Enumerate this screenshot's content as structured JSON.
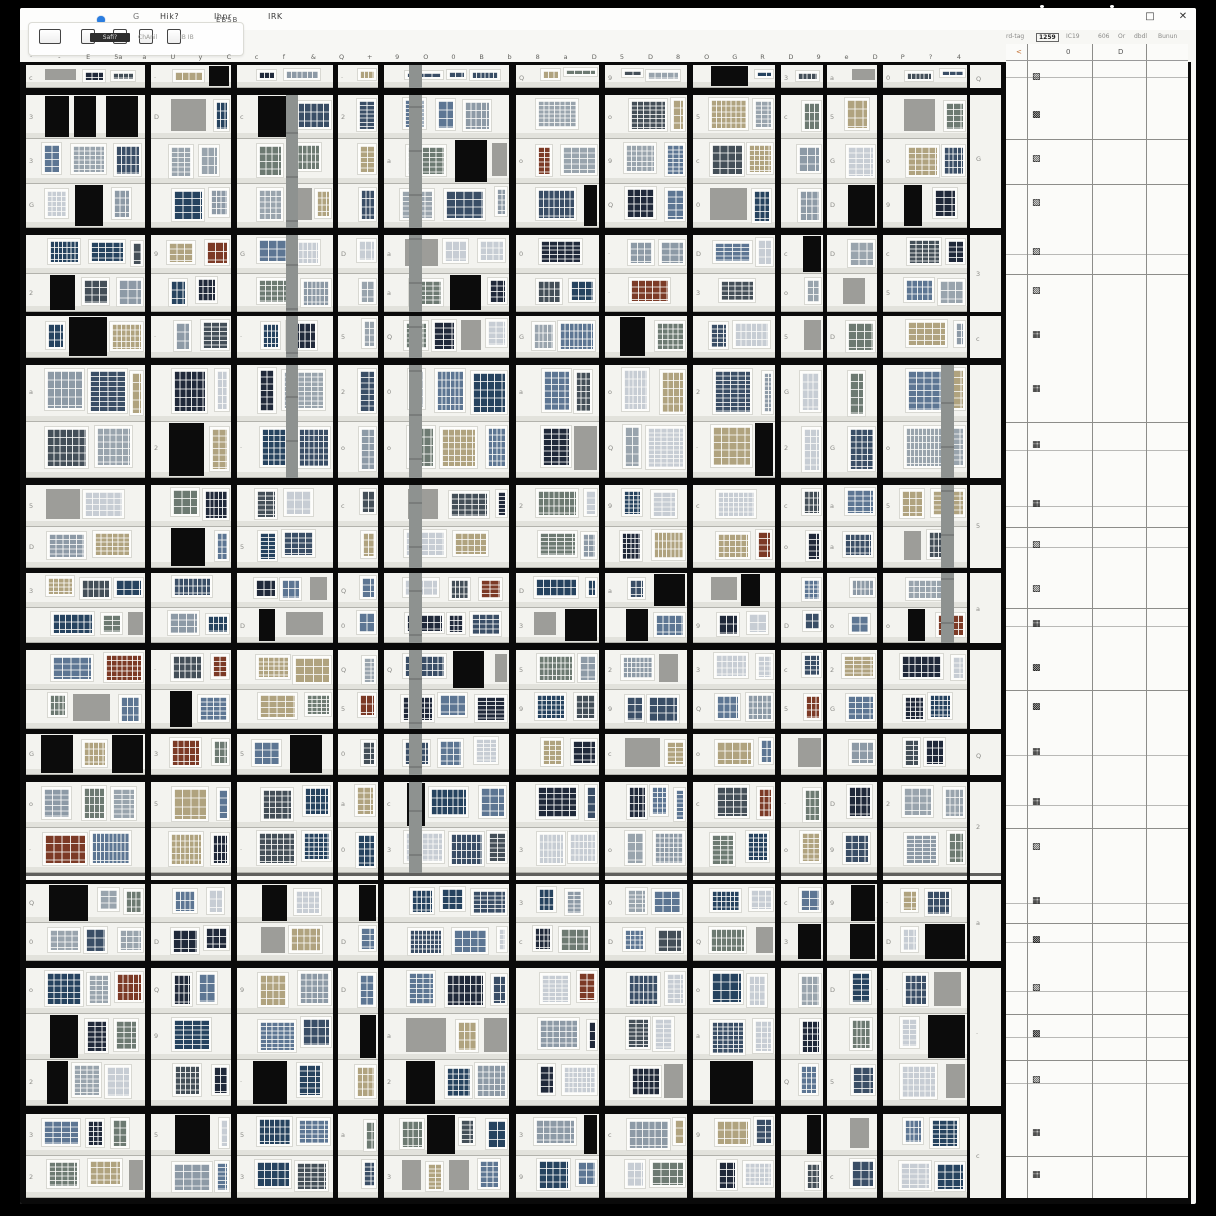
{
  "titlebar": {
    "menu": [
      "Hik?",
      "Ihnr",
      "IRK"
    ],
    "maximize_glyph": "□",
    "close_glyph": "✕",
    "app_glyph": "G"
  },
  "toolbar": {
    "icons": [
      "printer-icon",
      "book-icon",
      "clipboard-icon",
      "page-icon",
      "copy-icon"
    ],
    "cluster": "EBSB",
    "chip": "Safi?",
    "small1": "ChAnil",
    "small2": "IB IB"
  },
  "tabs": {
    "labels": [
      "rd-tag",
      "1259",
      "IC19",
      "606",
      "Or",
      "dbdl",
      "Bunun"
    ],
    "selected_index": 1
  },
  "column_header_glyphs": [
    "·",
    "-",
    "E",
    "5a",
    "a",
    "U",
    "y",
    "C",
    "c",
    "f",
    "&",
    "Q",
    "+",
    "9",
    "O",
    "0",
    "B",
    "b",
    "8",
    "a",
    "D",
    "5",
    "D",
    "8",
    "O",
    "G",
    "R",
    "D",
    "9",
    "e",
    "D",
    "P",
    "?",
    "4"
  ],
  "gutter_glyph_chars": [
    "0",
    "9",
    "3",
    "5",
    "a",
    "Q",
    "o",
    "D",
    "·",
    "G",
    "2",
    "c"
  ],
  "side_table": {
    "header": [
      "<",
      "0",
      "D"
    ],
    "header_accent": "#c06a2a",
    "glyph_chars": [
      "▩",
      "▦",
      "▨",
      "▧"
    ]
  },
  "colors": {
    "line": "#0a0a0a",
    "wall": "#f3f3ef",
    "frame": "#fdfdfb",
    "slab": "#e2e2dc",
    "floorline": "#b2b2ac",
    "panel": "#9d9d99",
    "shaft": "#8e9290",
    "opening": "#0c0c0c",
    "table_bg": "#fbfbf9",
    "glass": [
      "#3a4e66",
      "#5d7693",
      "#20293a",
      "#8d9aa6",
      "#b0a37f",
      "#6d7a72",
      "#26435f",
      "#99a4ad",
      "#c7cdd4",
      "#444f58"
    ],
    "glass_rare": "#7c3a26"
  },
  "grid": {
    "seed": 7,
    "vlines": [
      {
        "x": 0,
        "w": 6
      },
      {
        "x": 125,
        "w": 6
      },
      {
        "x": 211,
        "w": 6
      },
      {
        "x": 313,
        "w": 5
      },
      {
        "x": 358,
        "w": 6
      },
      {
        "x": 489,
        "w": 7
      },
      {
        "x": 579,
        "w": 6
      },
      {
        "x": 667,
        "w": 6
      },
      {
        "x": 755,
        "w": 6
      },
      {
        "x": 803,
        "w": 4
      },
      {
        "x": 857,
        "w": 6
      },
      {
        "x": 947,
        "w": 3
      },
      {
        "x": 981,
        "w": 5
      },
      {
        "x": 1168,
        "w": 3
      }
    ],
    "hlines": [
      {
        "y": 54,
        "h": 3
      },
      {
        "y": 80,
        "h": 7
      },
      {
        "y": 220,
        "h": 7
      },
      {
        "y": 304,
        "h": 4
      },
      {
        "y": 350,
        "h": 7
      },
      {
        "y": 470,
        "h": 7
      },
      {
        "y": 560,
        "h": 5
      },
      {
        "y": 635,
        "h": 7
      },
      {
        "y": 721,
        "h": 5
      },
      {
        "y": 767,
        "h": 7
      },
      {
        "y": 865,
        "h": 3,
        "c": "#5f5f5d"
      },
      {
        "y": 872,
        "h": 4
      },
      {
        "y": 953,
        "h": 7
      },
      {
        "y": 1098,
        "h": 8
      },
      {
        "y": 1190,
        "h": 6
      }
    ],
    "shafts": [
      {
        "x": 389,
        "w": 13,
        "y1": 54,
        "y2": 865
      },
      {
        "x": 266,
        "w": 12,
        "y1": 80,
        "y2": 470
      },
      {
        "x": 921,
        "w": 13,
        "y1": 350,
        "y2": 635
      }
    ],
    "table": {
      "x": 981,
      "right": 1168,
      "vx": [
        1007,
        1072,
        1126
      ],
      "hdr_top": 36,
      "glyph_x": 1012
    }
  }
}
